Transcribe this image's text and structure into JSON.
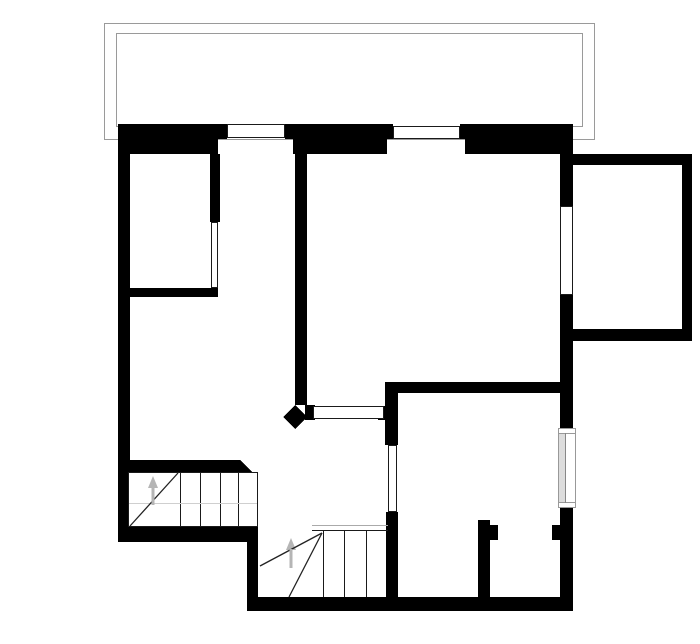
{
  "canvas": {
    "width": 700,
    "height": 644,
    "background": "#ffffff"
  },
  "palette": {
    "wall": "#000000",
    "balcony_line": "#9a9a9a",
    "thin_line": "#1a1a1a",
    "faint_line": "#cfcfcf",
    "gray_line": "#aaaaaa",
    "arrow": "#b5b5b5",
    "window_frame": "#999999",
    "glass_line": "#888888",
    "shade": "#dddddd",
    "background": "#ffffff"
  },
  "balcony": {
    "rects": [
      {
        "name": "balcony-outline-outer",
        "cls": "balcony",
        "x": 104.5,
        "y": 23.5,
        "w": 490,
        "h": 116
      },
      {
        "name": "balcony-outline-inner",
        "cls": "balcony",
        "x": 116.5,
        "y": 33.5,
        "w": 466,
        "h": 93
      }
    ]
  },
  "walls": {
    "rects": [
      {
        "name": "exterior-wall-top-outer-1",
        "cls": "wall",
        "x": 118,
        "y": 124,
        "w": 109,
        "h": 15
      },
      {
        "name": "exterior-wall-top-outer-2",
        "cls": "wall",
        "x": 285,
        "y": 124,
        "w": 108,
        "h": 15
      },
      {
        "name": "exterior-wall-top-outer-3",
        "cls": "wall",
        "x": 460,
        "y": 124,
        "w": 113,
        "h": 15
      },
      {
        "name": "exterior-wall-top-inner-1",
        "cls": "wall",
        "x": 118,
        "y": 139,
        "w": 100,
        "h": 15
      },
      {
        "name": "exterior-wall-top-inner-2",
        "cls": "wall",
        "x": 293,
        "y": 139,
        "w": 94,
        "h": 15
      },
      {
        "name": "exterior-wall-top-inner-3",
        "cls": "wall",
        "x": 465,
        "y": 139,
        "w": 108,
        "h": 15
      },
      {
        "name": "exterior-wall-left",
        "cls": "wall",
        "x": 118,
        "y": 124,
        "w": 12,
        "h": 418
      },
      {
        "name": "room1-wall-right",
        "cls": "wall",
        "x": 210,
        "y": 154,
        "w": 10,
        "h": 68
      },
      {
        "name": "room1-wall-bottom",
        "cls": "wall",
        "x": 128,
        "y": 288,
        "w": 90,
        "h": 9
      },
      {
        "name": "interior-wall-middle",
        "cls": "wall",
        "x": 295,
        "y": 154,
        "w": 12,
        "h": 251
      },
      {
        "name": "counter-stub-left",
        "cls": "wall",
        "x": 305,
        "y": 405,
        "w": 10,
        "h": 15
      },
      {
        "name": "counter-stub-right",
        "cls": "wall",
        "x": 378,
        "y": 406,
        "w": 7,
        "h": 14
      },
      {
        "name": "kitchen-doorway-wall-upper",
        "cls": "wall",
        "x": 385,
        "y": 382,
        "w": 13,
        "h": 63
      },
      {
        "name": "kitchen-doorway-wall-lower",
        "cls": "wall",
        "x": 386,
        "y": 512,
        "w": 12,
        "h": 85
      },
      {
        "name": "bedroom-wall-top",
        "cls": "wall",
        "x": 385,
        "y": 382,
        "w": 188,
        "h": 11
      },
      {
        "name": "exterior-wall-right-1",
        "cls": "wall",
        "x": 560,
        "y": 154,
        "w": 13,
        "h": 52
      },
      {
        "name": "exterior-wall-right-2",
        "cls": "wall",
        "x": 560,
        "y": 295,
        "w": 13,
        "h": 133
      },
      {
        "name": "exterior-wall-right-3",
        "cls": "wall",
        "x": 560,
        "y": 508,
        "w": 13,
        "h": 103
      },
      {
        "name": "annex-wall-top",
        "cls": "wall",
        "x": 573,
        "y": 154,
        "w": 119,
        "h": 11
      },
      {
        "name": "annex-wall-right",
        "cls": "wall",
        "x": 682,
        "y": 154,
        "w": 10,
        "h": 187
      },
      {
        "name": "annex-wall-bottom",
        "cls": "wall",
        "x": 560,
        "y": 329,
        "w": 132,
        "h": 12
      },
      {
        "name": "closet-wall-left",
        "cls": "wall",
        "x": 478,
        "y": 520,
        "w": 12,
        "h": 77
      },
      {
        "name": "closet-door-jamb-left",
        "cls": "wall",
        "x": 490,
        "y": 525,
        "w": 8,
        "h": 15
      },
      {
        "name": "closet-door-jamb-right",
        "cls": "wall",
        "x": 552,
        "y": 525,
        "w": 8,
        "h": 15
      },
      {
        "name": "exterior-wall-bottom",
        "cls": "wall",
        "x": 247,
        "y": 597,
        "w": 326,
        "h": 14
      },
      {
        "name": "stair-step-wall",
        "cls": "wall",
        "x": 247,
        "y": 527,
        "w": 11,
        "h": 70
      },
      {
        "name": "stair-upper-wall-top",
        "cls": "wall",
        "x": 128,
        "y": 460,
        "w": 112,
        "h": 12
      },
      {
        "name": "stair-upper-wall-bottom",
        "cls": "wall",
        "x": 118,
        "y": 527,
        "w": 140,
        "h": 15
      }
    ],
    "polys": [
      {
        "name": "stair-upper-wall-top-slant",
        "cls": "wall",
        "points": "240,460 252,472 240,472"
      },
      {
        "name": "column-diamond",
        "cls": "wall",
        "points": "295,405 307,417 295,429 283,417"
      }
    ]
  },
  "windows": {
    "rects": [
      {
        "name": "window-top-1",
        "cls": "glass",
        "x": 227.5,
        "y": 124.5,
        "w": 57,
        "h": 13
      },
      {
        "name": "window-top-2",
        "cls": "glass",
        "x": 393.5,
        "y": 126.5,
        "w": 66,
        "h": 12
      },
      {
        "name": "window-right-upper",
        "cls": "glass",
        "x": 560.5,
        "y": 206.5,
        "w": 12,
        "h": 88
      },
      {
        "name": "glass-door-room1",
        "cls": "glass",
        "x": 211.5,
        "y": 222.5,
        "w": 6,
        "h": 65
      },
      {
        "name": "pass-through-counter",
        "cls": "glass",
        "x": 313.5,
        "y": 406.5,
        "w": 70,
        "h": 12
      },
      {
        "name": "door-opening-kitchen",
        "cls": "glass",
        "x": 388.5,
        "y": 445.5,
        "w": 8,
        "h": 66
      }
    ]
  },
  "framed_window": {
    "rects": [
      {
        "name": "window-right-lower-frame",
        "cls": "frame",
        "x": 558.5,
        "y": 428.5,
        "w": 17,
        "h": 79
      },
      {
        "name": "window-right-lower-shade",
        "cls": "shade",
        "x": 559,
        "y": 433,
        "w": 6,
        "h": 70
      }
    ],
    "lines": [
      {
        "name": "window-right-lower-cap-top",
        "cls": "frame-line",
        "x1": 558.5,
        "y1": 433.5,
        "x2": 575.5,
        "y2": 433.5
      },
      {
        "name": "window-right-lower-cap-bottom",
        "cls": "frame-line",
        "x1": 558.5,
        "y1": 502.5,
        "x2": 575.5,
        "y2": 502.5
      },
      {
        "name": "window-right-lower-glass-line",
        "cls": "glass-line",
        "x1": 565.5,
        "y1": 433,
        "x2": 565.5,
        "y2": 503
      }
    ]
  },
  "stair_upper": {
    "rects": [
      {
        "name": "stair-upper-box",
        "cls": "stair-box",
        "x": 128.5,
        "y": 472.5,
        "w": 129,
        "h": 54
      }
    ],
    "lines": [
      {
        "name": "stair-upper-tread-1",
        "cls": "tread",
        "x1": 180.5,
        "y1": 472.5,
        "x2": 180.5,
        "y2": 527
      },
      {
        "name": "stair-upper-tread-2",
        "cls": "tread",
        "x1": 200.5,
        "y1": 472.5,
        "x2": 200.5,
        "y2": 527
      },
      {
        "name": "stair-upper-tread-3",
        "cls": "tread",
        "x1": 220.5,
        "y1": 472.5,
        "x2": 220.5,
        "y2": 527
      },
      {
        "name": "stair-upper-tread-4",
        "cls": "tread",
        "x1": 238.5,
        "y1": 472.5,
        "x2": 238.5,
        "y2": 527
      },
      {
        "name": "stair-upper-faint-line",
        "cls": "faint",
        "x1": 129,
        "y1": 503.5,
        "x2": 257,
        "y2": 503.5
      },
      {
        "name": "stair-upper-winder-diagonal",
        "cls": "diag",
        "x1": 130,
        "y1": 526,
        "x2": 178,
        "y2": 473
      },
      {
        "name": "stair-upper-arrow-shaft",
        "cls": "arrow-shaft",
        "x1": 153,
        "y1": 505,
        "x2": 153,
        "y2": 487
      }
    ],
    "polys": [
      {
        "name": "stair-upper-arrow-head",
        "cls": "arrow-head",
        "points": "153,476 148,488 158,488"
      }
    ]
  },
  "stair_lower": {
    "lines": [
      {
        "name": "stair-lower-edge-gray",
        "cls": "gray",
        "x1": 312,
        "y1": 525.5,
        "x2": 388,
        "y2": 525.5
      },
      {
        "name": "stair-lower-edge-dark",
        "cls": "tread",
        "x1": 312,
        "y1": 530.5,
        "x2": 388,
        "y2": 530.5
      },
      {
        "name": "stair-lower-tread-1",
        "cls": "tread",
        "x1": 323.5,
        "y1": 531,
        "x2": 323.5,
        "y2": 597
      },
      {
        "name": "stair-lower-tread-2",
        "cls": "tread",
        "x1": 344.5,
        "y1": 531,
        "x2": 344.5,
        "y2": 597
      },
      {
        "name": "stair-lower-tread-3",
        "cls": "tread",
        "x1": 366.5,
        "y1": 531,
        "x2": 366.5,
        "y2": 597
      },
      {
        "name": "stair-lower-winder-diagonal-1",
        "cls": "diag",
        "x1": 322,
        "y1": 533,
        "x2": 260,
        "y2": 566
      },
      {
        "name": "stair-lower-winder-diagonal-2",
        "cls": "diag",
        "x1": 322,
        "y1": 533,
        "x2": 289,
        "y2": 597
      },
      {
        "name": "stair-lower-arrow-shaft",
        "cls": "arrow-shaft",
        "x1": 291,
        "y1": 568,
        "x2": 291,
        "y2": 549
      }
    ],
    "polys": [
      {
        "name": "stair-lower-arrow-head",
        "cls": "arrow-head",
        "points": "291,538 286,550 296,550"
      }
    ]
  }
}
